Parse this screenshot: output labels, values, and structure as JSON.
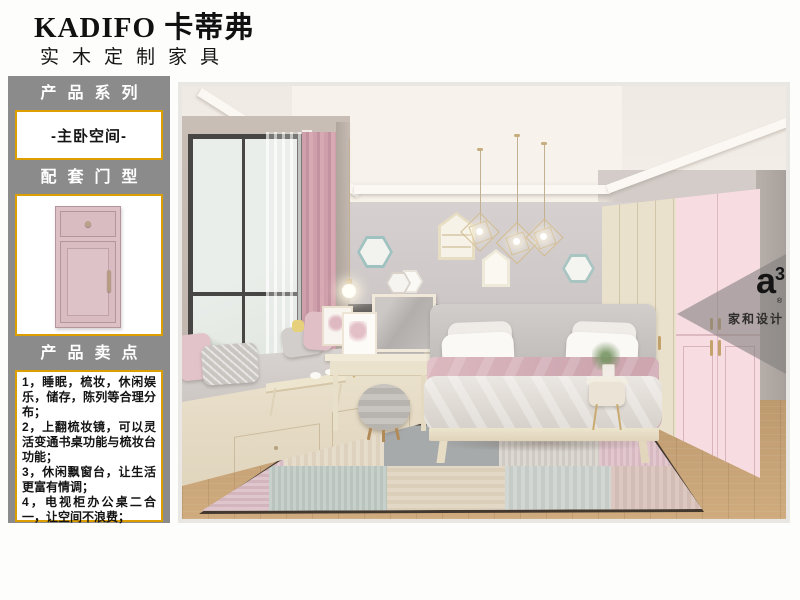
{
  "header": {
    "brand": "KADIFO 卡蒂弗",
    "subtitle": "实木定制家具"
  },
  "sidebar": {
    "series_title": "产品系列",
    "series_value": "-主卧空间-",
    "door_title": "配套门型",
    "selling_title": "产品卖点",
    "selling_points": [
      "1，睡眠，梳妆，休闲娱乐，储存，陈列等合理分布；",
      "2，上翻梳妆镜，可以灵活变通书桌功能与梳妆台功能；",
      "3，休闲飘窗台，让生活更富有情调；",
      "4，电视柜办公桌二合一，让空间不浪费；"
    ]
  },
  "watermark": {
    "logo": "a",
    "logo_sup": "3",
    "registered": "®",
    "name": "家和设计"
  },
  "colors": {
    "sidebar_bg": "#8b8b8b",
    "accent_gold": "#dd9e00",
    "door_pink": "#dcc0c6",
    "wardrobe_pink": "#f7dce2",
    "wardrobe_cream": "#eae1cc",
    "wall_gray": "#cdc7c6",
    "curtain_pink": "#cfa0ab",
    "floor_wood": "#c7a277"
  }
}
